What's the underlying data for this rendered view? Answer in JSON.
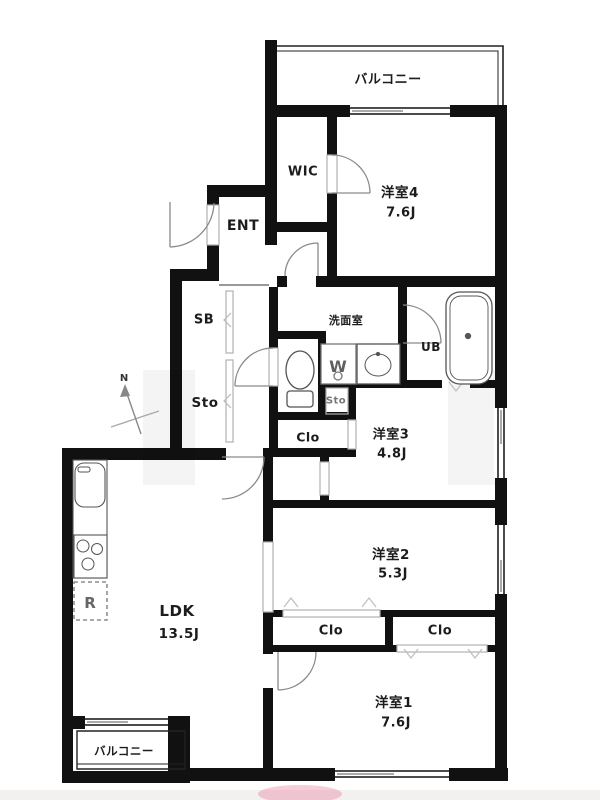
{
  "plan": {
    "compass": "N",
    "labels": {
      "balcony_top": "バルコニー",
      "wic": "WIC",
      "room4": "洋室4",
      "room4_size": "7.6J",
      "ent": "ENT",
      "sb": "SB",
      "sto_hall": "Sto",
      "washroom": "洗面室",
      "washer": "W",
      "ub": "UB",
      "sto_small": "Sto",
      "clo_hall": "Clo",
      "room3": "洋室3",
      "room3_size": "4.8J",
      "room2": "洋室2",
      "room2_size": "5.3J",
      "ldk": "LDK",
      "ldk_size": "13.5J",
      "clo_left": "Clo",
      "clo_right": "Clo",
      "room1": "洋室1",
      "room1_size": "7.6J",
      "balcony_bottom": "バルコニー",
      "fridge": "R"
    },
    "colors": {
      "wall": "#111111",
      "door_line": "#8a8a8a",
      "frame_line": "#b0b0b0",
      "fixture_line": "#555555",
      "watermark_pink": "#e8719a"
    }
  }
}
